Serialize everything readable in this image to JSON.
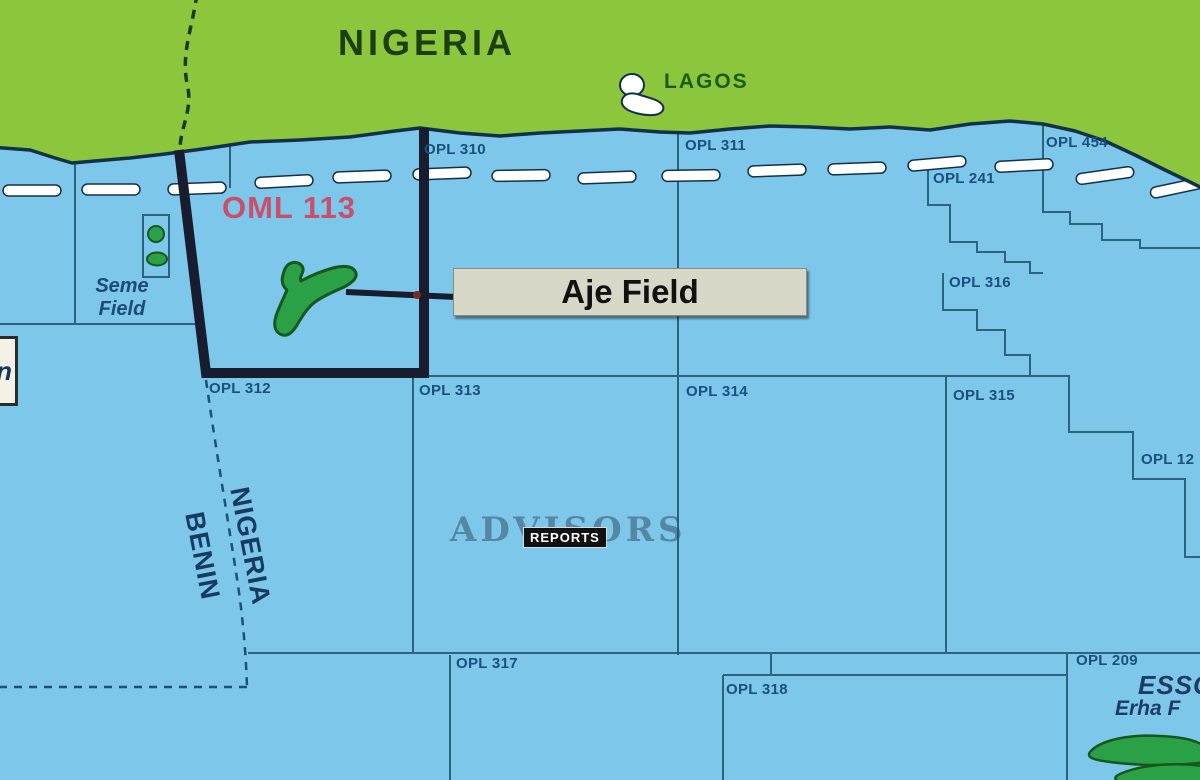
{
  "colors": {
    "water": "#7cc7ea",
    "land": "#8cc63c",
    "coast": "#13304a",
    "boundary": "#2e627f",
    "oml-outline": "#171c2f",
    "block-label": "#1a4f80",
    "oml-label": "#cb4f6b",
    "country-label": "#1d3e10",
    "city-label": "#1a5c12",
    "field-green": "#2aa146",
    "field-outline": "#16561f",
    "callout-bg": "#d7d8c7",
    "callout-text": "#111111",
    "border-dash": "#1d4f78",
    "watermark": "rgba(52,80,104,0.55)",
    "badge-bg": "#111111",
    "badge-text": "#ffffff",
    "seme-label": "#1d4a77",
    "edge-box": "#f4f1e6"
  },
  "map": {
    "country_label": "NIGERIA",
    "city_label": "LAGOS",
    "oml_label": "OML 113",
    "aje_label": "Aje Field",
    "seme_field": {
      "line1": "Seme",
      "line2": "Field"
    },
    "maritime_border": {
      "nigeria": "NIGERIA",
      "benin": "BENIN"
    },
    "edge_label": "n",
    "bottom_right": {
      "operator": "ESSO",
      "field": "Erha F"
    },
    "watermark": {
      "word": "ADVISORS",
      "badge": "REPORTS"
    },
    "block_labels": [
      {
        "id": "opl-310",
        "text": "OPL 310",
        "x": 424,
        "y": 141
      },
      {
        "id": "opl-311",
        "text": "OPL 311",
        "x": 685,
        "y": 137
      },
      {
        "id": "opl-454",
        "text": "OPL 454",
        "x": 1046,
        "y": 134
      },
      {
        "id": "opl-241",
        "text": "OPL 241",
        "x": 933,
        "y": 170
      },
      {
        "id": "opl-316",
        "text": "OPL 316",
        "x": 949,
        "y": 274
      },
      {
        "id": "opl-312",
        "text": "OPL 312",
        "x": 209,
        "y": 380
      },
      {
        "id": "opl-313",
        "text": "OPL 313",
        "x": 419,
        "y": 382
      },
      {
        "id": "opl-314",
        "text": "OPL 314",
        "x": 686,
        "y": 383
      },
      {
        "id": "opl-315",
        "text": "OPL 315",
        "x": 953,
        "y": 387
      },
      {
        "id": "opl-12",
        "text": "OPL 12",
        "x": 1141,
        "y": 451
      },
      {
        "id": "opl-317",
        "text": "OPL 317",
        "x": 456,
        "y": 655
      },
      {
        "id": "opl-318",
        "text": "OPL 318",
        "x": 726,
        "y": 681
      },
      {
        "id": "opl-209",
        "text": "OPL 209",
        "x": 1076,
        "y": 652
      }
    ]
  }
}
